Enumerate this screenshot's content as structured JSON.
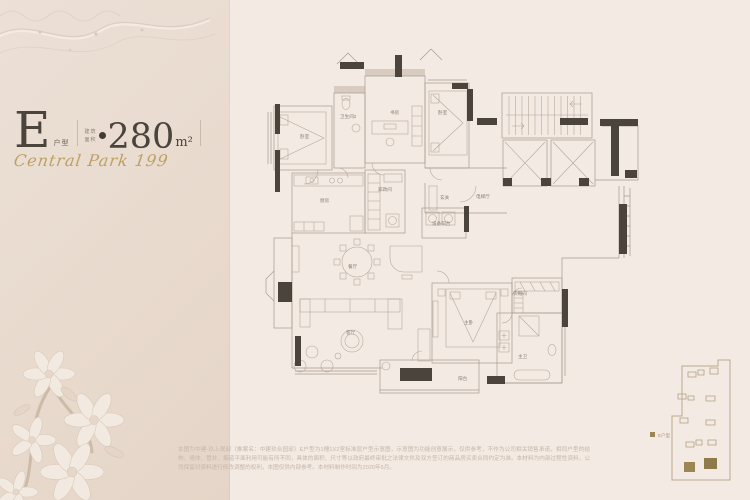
{
  "left_panel": {
    "unit_letter": "E",
    "unit_suffix": "户型",
    "area_prefix_line1": "建筑",
    "area_prefix_line2": "面积",
    "area_value": "280",
    "area_unit": "m²",
    "brand_script": "Central Park 199"
  },
  "floorplan": {
    "rooms": [
      {
        "id": "bedroom-2",
        "label": "卧室"
      },
      {
        "id": "bathroom-2",
        "label": "卫生间2"
      },
      {
        "id": "study",
        "label": "书房"
      },
      {
        "id": "bedroom-3",
        "label": "卧室"
      },
      {
        "id": "kitchen",
        "label": "厨房"
      },
      {
        "id": "housekeeping-room",
        "label": "家政间"
      },
      {
        "id": "entry",
        "label": "玄关"
      },
      {
        "id": "elevator-hall",
        "label": "电梯厅"
      },
      {
        "id": "equipment-balcony",
        "label": "设备阳台"
      },
      {
        "id": "dining-room",
        "label": "餐厅"
      },
      {
        "id": "living-room",
        "label": "客厅"
      },
      {
        "id": "master-bedroom",
        "label": "主卧"
      },
      {
        "id": "walk-in-closet",
        "label": "衣帽间"
      },
      {
        "id": "master-bath",
        "label": "主卫"
      },
      {
        "id": "balcony",
        "label": "阳台"
      }
    ]
  },
  "keymap": {
    "legend": "E户型"
  },
  "disclaimer": {
    "text": "本图为中建·玖上观邸（推案名：中建玖合园邸）E户型为1幢1X2室标准层户型示意图，示意图为功能创意展示，仅供参考，不作为公司相关销售承诺，相同户型的结构、墙体、管井、烟道平面利用可能有所不同，具体的面积、尺寸等以政府最终审批之法律文件及双方签订的商品房买卖合同约定为准。本材料为内部过程性资料，公司保留对资料进行修改调整的权利，本图仅供内部参考。本材料制作时间为2020年5月。"
  },
  "colors": {
    "panel_bg": "#e9dccf",
    "main_bg": "#f3eae3",
    "ink": "#4a443d",
    "gold": "#bda063",
    "wall": "#4b443d",
    "plan_line": "#a89b8f"
  }
}
